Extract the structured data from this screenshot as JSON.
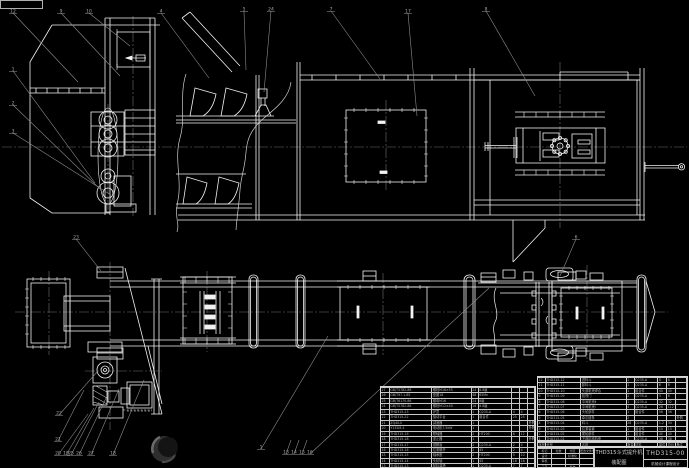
{
  "meta": {
    "drawing_kind": "CAD assembly drawing, bucket elevator"
  },
  "colors": {
    "background": "#000000",
    "linework": "#f2f2f2",
    "auxiliary": "#8c8c8c",
    "table_text": "#b4b4b4"
  },
  "title_block": {
    "product_title": "THD315斗式提升机",
    "drawing_type": "装配图",
    "drawing_number": "THD315-00",
    "org": "机械设计课程设计",
    "sig_grid": [
      [
        "标记",
        "处数",
        "分区",
        "更改文件号"
      ],
      [
        "设计",
        "",
        "标准化",
        ""
      ],
      [
        "审核",
        "",
        "",
        ""
      ],
      [
        "工艺",
        "",
        "批准",
        ""
      ]
    ]
  },
  "bom": {
    "columns": [
      "序号",
      "代号",
      "名称",
      "数量",
      "材料",
      "单件",
      "总计",
      "备注"
    ],
    "right_rows": [
      [
        "12",
        "THD315-12",
        "进料斗",
        "1",
        "Q235-A",
        "8",
        "8",
        ""
      ],
      [
        "11",
        "THD315-11",
        "卸料斗",
        "1",
        "Q235-A",
        "6",
        "6",
        ""
      ],
      [
        "10",
        "THD315-10",
        "头部机壳焊合",
        "1",
        "组合件",
        "45",
        "45",
        ""
      ],
      [
        "9",
        "THD315-09",
        "检视门",
        "2",
        "Q235-A",
        "3",
        "6",
        ""
      ],
      [
        "8",
        "THD315-08",
        "中间机壳Ⅱ",
        "1",
        "Q235-A",
        "32",
        "32",
        ""
      ],
      [
        "7",
        "THD315-07",
        "中间机壳Ⅰ",
        "4",
        "Q235-A",
        "28",
        "112",
        ""
      ],
      [
        "6",
        "THD315-06",
        "头轮部件",
        "1",
        "组合件",
        "56",
        "56",
        ""
      ],
      [
        "5",
        "THD315-05",
        "牵引链条",
        "2",
        "",
        "",
        "",
        "外购"
      ],
      [
        "4",
        "THD315-04",
        "料斗",
        "28",
        "Q235-A",
        "1.2",
        "34",
        ""
      ],
      [
        "3",
        "THD315-03",
        "拉紧装置",
        "1",
        "组合件",
        "15",
        "15",
        ""
      ],
      [
        "2",
        "THD315-02",
        "尾轮部件",
        "1",
        "组合件",
        "40",
        "40",
        ""
      ],
      [
        "1",
        "THD315-01",
        "下部区段机壳",
        "1",
        "Q235-A",
        "38",
        "38",
        ""
      ]
    ],
    "left_rows": [
      [
        "27",
        "GB/T5782-86",
        "螺栓M16×55",
        "24",
        "8.8级",
        "",
        "",
        ""
      ],
      [
        "26",
        "GB/T97.1-85",
        "垫圈16",
        "48",
        "65Mn",
        "",
        "",
        ""
      ],
      [
        "25",
        "GB/T6170-86",
        "螺母M16",
        "24",
        "8级",
        "",
        "",
        ""
      ],
      [
        "24",
        "GB/T5782-86",
        "螺栓M12×40",
        "16",
        "8.8级",
        "",
        "",
        ""
      ],
      [
        "23",
        "THD315-23",
        "护罩",
        "1",
        "Q235-A",
        "4",
        "4",
        ""
      ],
      [
        "22",
        "THD315-22",
        "驱动平台",
        "1",
        "组合件",
        "25",
        "25",
        ""
      ],
      [
        "21",
        "ZQ40-Ⅱ",
        "减速器",
        "1",
        "",
        "",
        "",
        "外购"
      ],
      [
        "20",
        "Y132M-4",
        "电动机7.5kW",
        "1",
        "",
        "",
        "",
        "外购"
      ],
      [
        "19",
        "THD315-19",
        "联轴器",
        "2",
        "HT200",
        "6",
        "12",
        ""
      ],
      [
        "18",
        "THD315-18",
        "逆止器",
        "1",
        "",
        "",
        "",
        "外购"
      ],
      [
        "17",
        "THD315-17",
        "观察窗",
        "2",
        "Q235-A",
        "2",
        "4",
        ""
      ],
      [
        "16",
        "THD315-16",
        "拉紧螺杆",
        "2",
        "45",
        "2",
        "4",
        ""
      ],
      [
        "15",
        "THD315-15",
        "轴承座",
        "2",
        "HT200",
        "5",
        "10",
        ""
      ],
      [
        "14",
        "THD315-14",
        "头轮轴",
        "1",
        "45",
        "18",
        "18",
        ""
      ],
      [
        "13",
        "THD315-13",
        "卸料溜槽",
        "1",
        "Q235-A",
        "7",
        "7",
        ""
      ]
    ]
  },
  "balloons": [
    {
      "label": "12",
      "x": 10,
      "y": 8,
      "tx": 78,
      "ty": 82
    },
    {
      "label": "9",
      "x": 58,
      "y": 8,
      "tx": 120,
      "ty": 76
    },
    {
      "label": "10",
      "x": 86,
      "y": 8,
      "tx": 130,
      "ty": 46
    },
    {
      "label": "4",
      "x": 158,
      "y": 8,
      "tx": 209,
      "ty": 78
    },
    {
      "label": "5",
      "x": 241,
      "y": 6,
      "tx": 246,
      "ty": 70
    },
    {
      "label": "24",
      "x": 268,
      "y": 6,
      "tx": 264,
      "ty": 92
    },
    {
      "label": "7",
      "x": 328,
      "y": 6,
      "tx": 380,
      "ty": 79
    },
    {
      "label": "17",
      "x": 405,
      "y": 8,
      "tx": 417,
      "ty": 116
    },
    {
      "label": "8",
      "x": 483,
      "y": 6,
      "tx": 535,
      "ty": 96
    },
    {
      "label": "1",
      "x": 10,
      "y": 66,
      "tx": 95,
      "ty": 183
    },
    {
      "label": "2",
      "x": 10,
      "y": 100,
      "tx": 100,
      "ty": 189
    },
    {
      "label": "3",
      "x": 10,
      "y": 128,
      "tx": 111,
      "ty": 195
    },
    {
      "label": "23",
      "x": 73,
      "y": 234,
      "tx": 101,
      "ty": 271
    },
    {
      "label": "22",
      "x": 56,
      "y": 410,
      "tx": 97,
      "ty": 372
    },
    {
      "label": "21",
      "x": 55,
      "y": 436,
      "tx": 84,
      "ty": 390
    },
    {
      "label": "20",
      "x": 55,
      "y": 450,
      "tx": 88,
      "ty": 414
    },
    {
      "label": "19",
      "x": 63,
      "y": 450,
      "tx": 94,
      "ty": 408
    },
    {
      "label": "25",
      "x": 68,
      "y": 450,
      "tx": 99,
      "ty": 402
    },
    {
      "label": "26",
      "x": 76,
      "y": 450,
      "tx": 107,
      "ty": 396
    },
    {
      "label": "27",
      "x": 88,
      "y": 450,
      "tx": 119,
      "ty": 389
    },
    {
      "label": "18",
      "x": 110,
      "y": 450,
      "tx": 144,
      "ty": 380
    },
    {
      "label": "1",
      "x": 258,
      "y": 444,
      "tx": 328,
      "ty": 336
    },
    {
      "label": "13",
      "x": 283,
      "y": 449,
      "tx": 291,
      "ty": 440
    },
    {
      "label": "14",
      "x": 291,
      "y": 449,
      "tx": 299,
      "ty": 440
    },
    {
      "label": "15",
      "x": 299,
      "y": 449,
      "tx": 307,
      "ty": 440
    },
    {
      "label": "16",
      "x": 307,
      "y": 449,
      "tx": 489,
      "ty": 288
    },
    {
      "label": "6",
      "x": 573,
      "y": 234,
      "tx": 560,
      "ty": 276
    }
  ]
}
